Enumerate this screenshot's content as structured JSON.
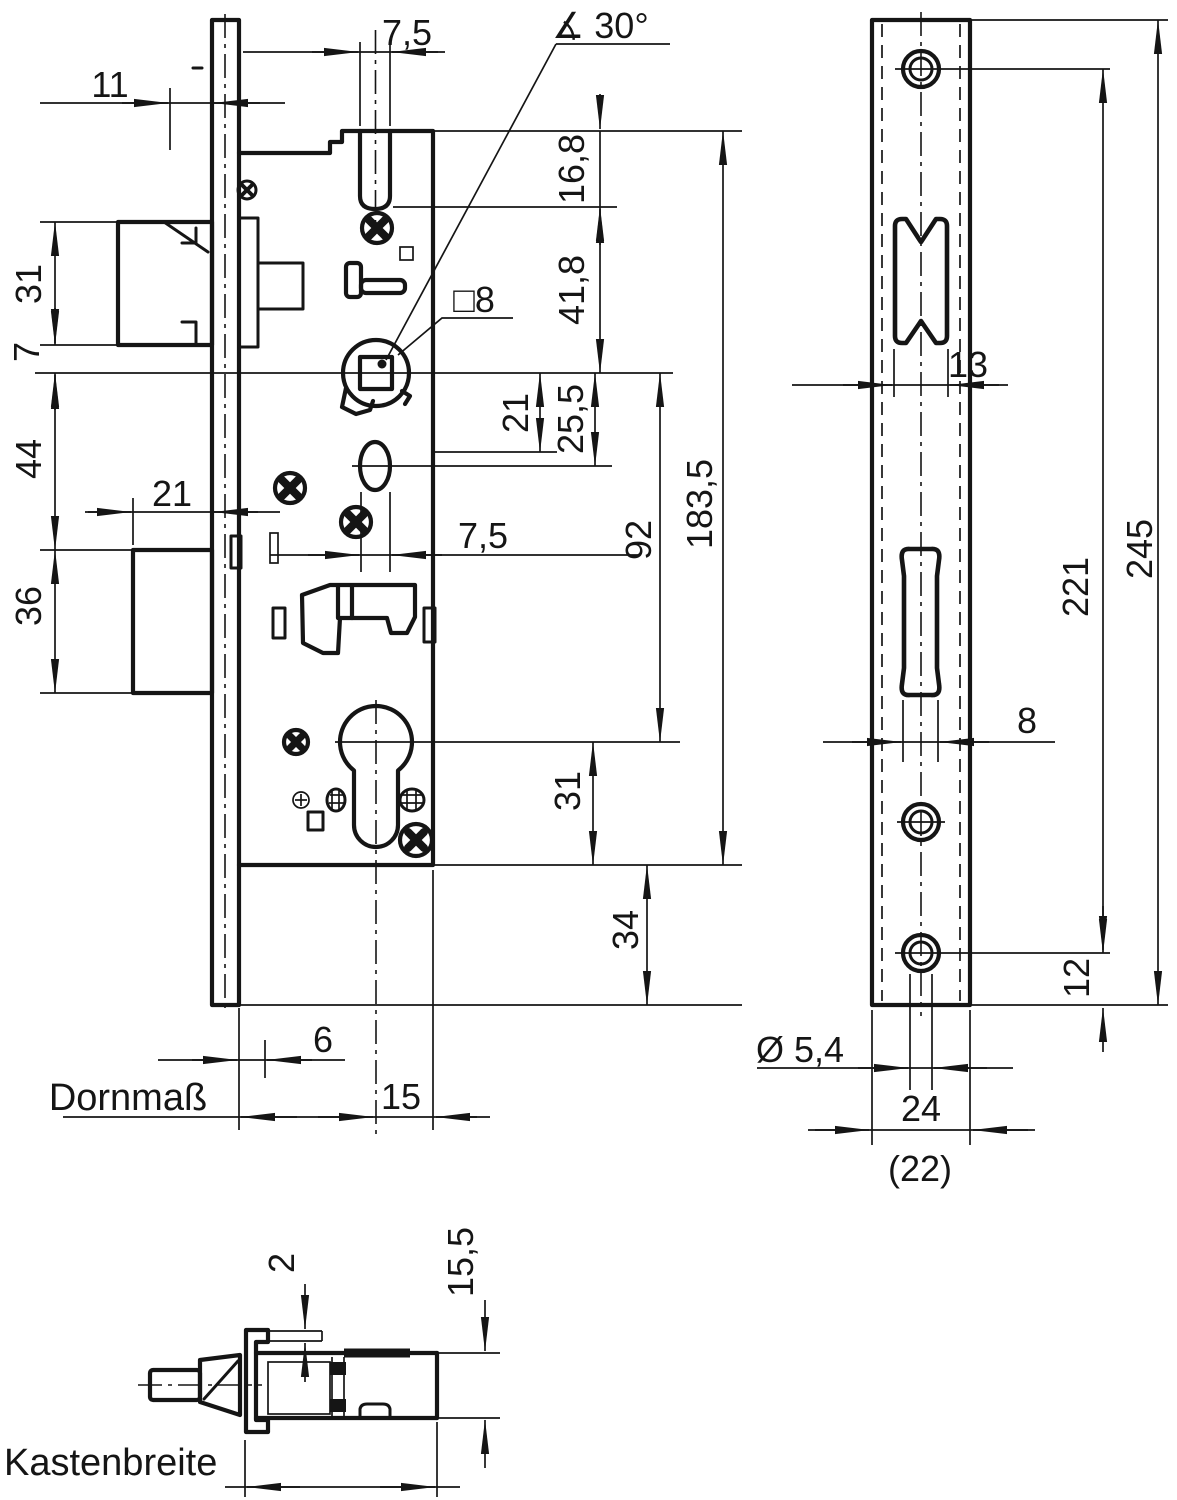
{
  "meta": {
    "drawing_type": "technical dimensional drawing of a mortise lock",
    "ink_color": "#151515",
    "background_color": "#ffffff"
  },
  "labels": {
    "d11": "11",
    "d31_latch": "31",
    "d7": "7",
    "d44": "44",
    "d36": "36",
    "d21_throw": "21",
    "d75_top": "7,5",
    "angle30": "∡ 30°",
    "sq8": "□8",
    "d168": "16,8",
    "d418": "41,8",
    "d21_mid": "21",
    "d255": "25,5",
    "d75_mid": "7,5",
    "d92": "92",
    "d1835": "183,5",
    "d31_cyl": "31",
    "d34": "34",
    "d6": "6",
    "d15": "15",
    "dornmass": "Dornmaß",
    "d13": "13",
    "d221": "221",
    "d245": "245",
    "d8": "8",
    "d12": "12",
    "dia54": "Ø 5,4",
    "d24": "24",
    "d22": "(22)",
    "d2": "2",
    "d155": "15,5",
    "kastenbreite": "Kastenbreite"
  }
}
